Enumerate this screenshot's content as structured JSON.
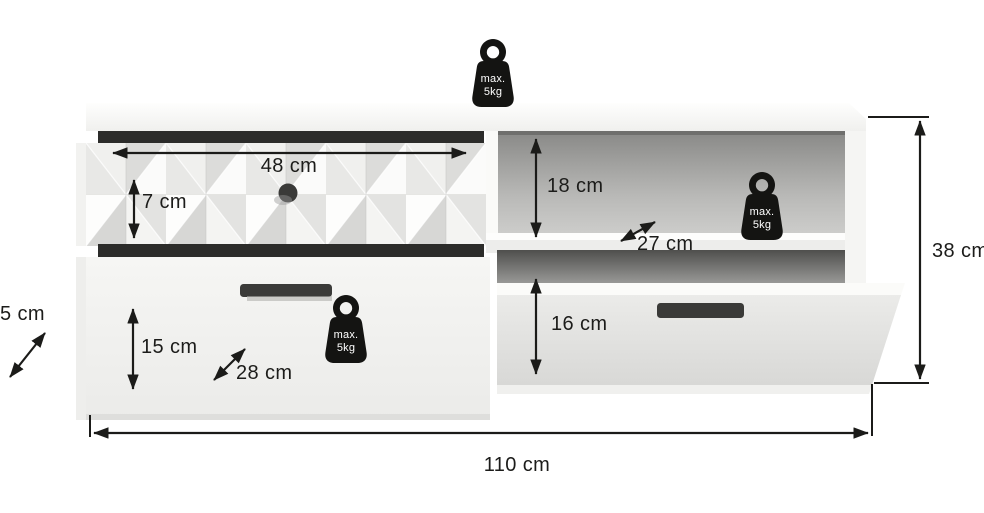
{
  "labels": {
    "width_48": "48 cm",
    "height_7": "7 cm",
    "height_18": "18 cm",
    "depth_27": "27 cm",
    "height_16": "16 cm",
    "height_15": "15 cm",
    "depth_28": "28 cm",
    "depth_5": "5 cm",
    "height_38": "38 cm",
    "width_110": "110 cm"
  },
  "weight_badge": {
    "line1": "max.",
    "line2": "5kg"
  },
  "colors": {
    "ink": "#1b1b19",
    "badge_black": "#141412",
    "recess_dark": "#2c2c2a",
    "handle_dark": "#3b3b39",
    "niche_gray_top": "#8a8a88",
    "niche_gray_bottom": "#d3d3d1"
  }
}
